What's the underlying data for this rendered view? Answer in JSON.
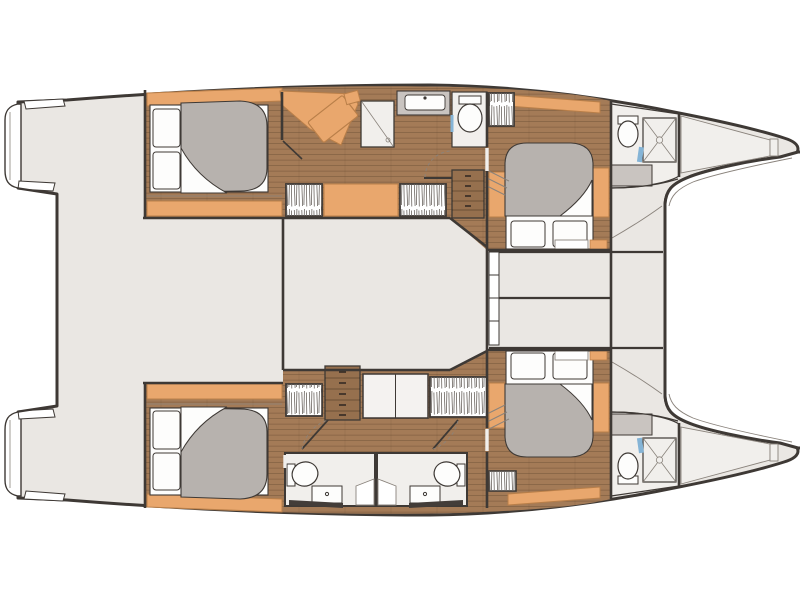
{
  "meta": {
    "diagram_type": "yacht deck floor plan",
    "vessel": "sailing catamaran",
    "view": "top-down",
    "bow_direction": "right"
  },
  "palette": {
    "background": "#ffffff",
    "deck": "#eae7e3",
    "room_floor": "#f1efec",
    "wood_floor": "#a47b57",
    "wood_plank_line": "#6e5138",
    "dresser_wood": "#96704e",
    "cabinet_orange": "#e9a76d",
    "orange_outline": "#b97f49",
    "duvet_gray": "#b7b2ae",
    "counter_gray": "#c9c4c0",
    "linen_white": "#fdfdfc",
    "outline_dark": "#3e3935",
    "line_soft": "#8a837c",
    "hatch_stroke": "#6b6560",
    "door_accent_blue": "#85b4d6",
    "bench_dark": "#433d39"
  },
  "fixtures": {
    "double_berths": 4,
    "toilets": 5,
    "shower_stalls": 3,
    "washbasins": 3,
    "hanging_lockers": 6,
    "dressers": 2,
    "staircases": 2,
    "chaise_longues": 1,
    "trampolines": 1,
    "swim_platforms": 2,
    "bow_lockers": 2
  }
}
